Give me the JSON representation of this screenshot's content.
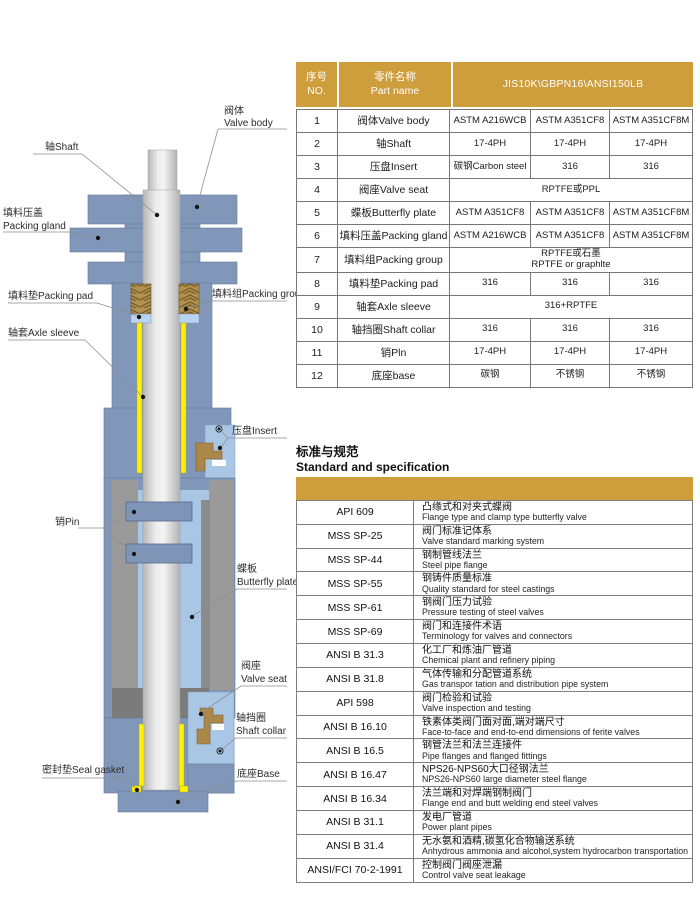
{
  "colors": {
    "gold": "#CE9D3C",
    "body_blue": "#8197BA",
    "light_blue": "#A9C6E4",
    "steel_gray": "#9A9A9A",
    "sleeve_yellow": "#FFF200",
    "packing_brown": "#B3914F"
  },
  "diagram": {
    "labels": {
      "valve_body_zh": "阀体",
      "valve_body_en": "Valve body",
      "shaft": "轴Shaft",
      "packing_gland_zh": "填料压盖",
      "packing_gland_en": "Packing gland",
      "packing_pad": "填料垫Packing pad",
      "packing_group": "填料组Packing group",
      "axle_sleeve": "轴套Axle sleeve",
      "insert": "压盘Insert",
      "pin": "销Pin",
      "butterfly_zh": "蝶板",
      "butterfly_en": "Butterfly plate",
      "valve_seat_zh": "阀座",
      "valve_seat_en": "Valve seat",
      "shaft_collar_zh": "轴挡圈",
      "shaft_collar_en": "Shaft collar",
      "seal_gasket": "密封垫Seal gasket",
      "base": "底座Base"
    }
  },
  "parts_table": {
    "header": {
      "no_zh": "序号",
      "no_en": "NO.",
      "name_zh": "零件名称",
      "name_en": "Part name",
      "spec": "JIS10K\\GBPN16\\ANSI150LB"
    },
    "rows": [
      {
        "no": "1",
        "name": "阀体Valve body",
        "materials": [
          "ASTM A216WCB",
          "ASTM A351CF8",
          "ASTM A351CF8M"
        ]
      },
      {
        "no": "2",
        "name": "轴Shaft",
        "materials": [
          "17-4PH",
          "17-4PH",
          "17-4PH"
        ]
      },
      {
        "no": "3",
        "name": "压盘Insert",
        "materials": [
          "碳钢Carbon steel",
          "316",
          "316"
        ]
      },
      {
        "no": "4",
        "name": "阀座Valve seat",
        "span": [
          "RPTFE或PPL"
        ]
      },
      {
        "no": "5",
        "name": "蝶板Butterfly plate",
        "materials": [
          "ASTM A351CF8",
          "ASTM A351CF8",
          "ASTM A351CF8M"
        ]
      },
      {
        "no": "6",
        "name": "填料压盖Packing gland",
        "materials": [
          "ASTM A216WCB",
          "ASTM A351CF8",
          "ASTM A351CF8M"
        ]
      },
      {
        "no": "7",
        "name": "填料组Packing group",
        "span": [
          "RPTFE或石墨",
          "RPTFE or graphlte"
        ]
      },
      {
        "no": "8",
        "name": "填料垫Packing pad",
        "materials": [
          "316",
          "316",
          "316"
        ]
      },
      {
        "no": "9",
        "name": "轴套Axle sleeve",
        "span": [
          "316+RPTFE"
        ]
      },
      {
        "no": "10",
        "name": "轴挡圈Shaft collar",
        "materials": [
          "316",
          "316",
          "316"
        ]
      },
      {
        "no": "11",
        "name": "销Pln",
        "materials": [
          "17-4PH",
          "17-4PH",
          "17-4PH"
        ]
      },
      {
        "no": "12",
        "name": "底座base",
        "materials": [
          "碳钢",
          "不锈钢",
          "不锈钢"
        ]
      }
    ]
  },
  "standards_section": {
    "title_zh": "标准与规范",
    "title_en": "Standard and specification"
  },
  "standards_table": {
    "rows": [
      {
        "code": "API 609",
        "zh": "凸缘式和对夹式蝶阀",
        "en": "Flange type and clamp type butterfly valve"
      },
      {
        "code": "MSS SP-25",
        "zh": "阀门标准记体系",
        "en": "Valve standard marking system"
      },
      {
        "code": "MSS SP-44",
        "zh": "钢制管线法兰",
        "en": "Steel pipe flange"
      },
      {
        "code": "MSS SP-55",
        "zh": "钢铸件质量标准",
        "en": "Quality standard for steel castings"
      },
      {
        "code": "MSS SP-61",
        "zh": "钢阀门压力试验",
        "en": "Pressure testing of steel valves"
      },
      {
        "code": "MSS SP-69",
        "zh": "阀门和连接件术语",
        "en": "Terminology for valves and connectors"
      },
      {
        "code": "ANSI B 31.3",
        "zh": "化工厂和炼油厂管道",
        "en": "Chemical plant and refinery piping"
      },
      {
        "code": "ANSI B 31.8",
        "zh": "气体传输和分配管道系统",
        "en": "Gas transpor tation and distribution pipe system"
      },
      {
        "code": "API 598",
        "zh": "阀门检验和试验",
        "en": "Valve inspection and testing"
      },
      {
        "code": "ANSI B 16.10",
        "zh": "铁素体类阀门面对面,端对端尺寸",
        "en": "Face-to-face and end-to-end dimensions of ferite valves"
      },
      {
        "code": "ANSI B 16.5",
        "zh": "钢管法兰和法兰连接件",
        "en": "Pipe flanges and flanged fittings"
      },
      {
        "code": "ANSI B 16.47",
        "zh": "NPS26-NPS60大口径钢法兰",
        "en": "NPS26-NPS60 large diameter steel flange"
      },
      {
        "code": "ANSI B 16.34",
        "zh": "法兰端和对焊端钢制阀门",
        "en": "Flange end and butt welding end steel valves"
      },
      {
        "code": "ANSI B 31.1",
        "zh": "发电厂管道",
        "en": "Power plant pipes"
      },
      {
        "code": "ANSI B 31.4",
        "zh": "无水氨和酒精,碳氢化合物输送系统",
        "en": "Anhydrous ammonia and alcohol,system hydrocarbon transportation"
      },
      {
        "code": "ANSI/FCI 70-2-1991",
        "zh": "控制阀门阀座泄漏",
        "en": "Control valve seat leakage"
      }
    ]
  }
}
